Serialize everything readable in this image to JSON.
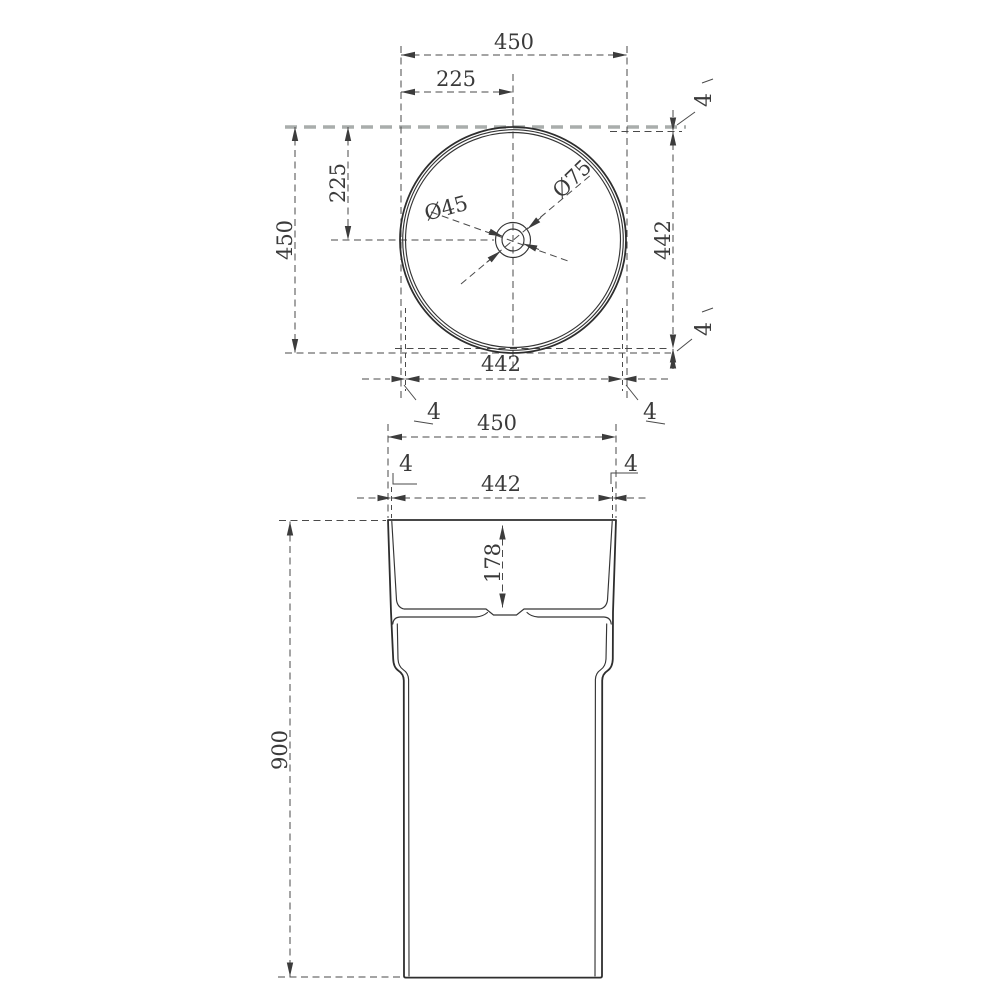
{
  "top_view": {
    "overall_width": "450",
    "half_width": "225",
    "overall_height": "450",
    "half_height": "225",
    "inner_width": "442",
    "inner_height": "442",
    "rim_gap": "4",
    "drain_outer_dia": "Ø75",
    "drain_inner_dia": "Ø45"
  },
  "front_view": {
    "overall_width": "450",
    "inner_width": "442",
    "wall_thickness": "4",
    "basin_depth": "178",
    "overall_height": "900"
  },
  "colors": {
    "outline": "#2e2e2e",
    "dimension": "#4a4a4a",
    "tangent_gray": "#a9adac",
    "background": "#ffffff"
  }
}
